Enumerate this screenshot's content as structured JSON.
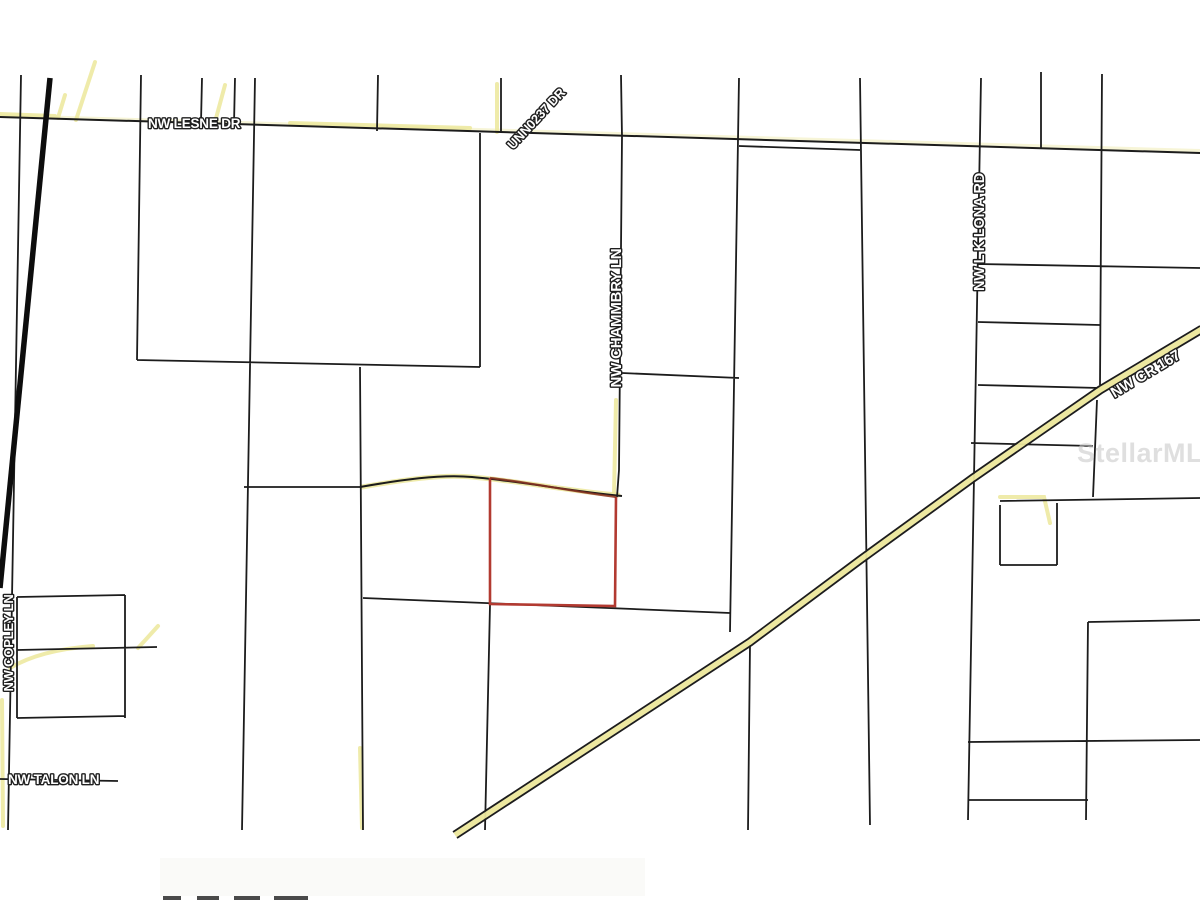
{
  "map": {
    "type": "parcel-plat-map",
    "road_labels": {
      "lesne": "NW LESNE DR",
      "unn0237": "UNN0237 DR",
      "chammbry": "NW CHAMMBRY LN",
      "lk_lona": "NW L K LONA RD",
      "cr167": "NW CR 167",
      "copley": "NW COPLEY LN",
      "talon": "NW TALON LN"
    },
    "watermark": "StellarMLS",
    "colors": {
      "background": "#ffffff",
      "parcel_line": "#1c1c1c",
      "subject_parcel_outline": "#b23a31",
      "road_highlight_yellow": "#ece79b",
      "label_fill": "#ffffff",
      "label_outline": "#1f1f1f",
      "watermark_gray": "#c9c9c9"
    }
  }
}
